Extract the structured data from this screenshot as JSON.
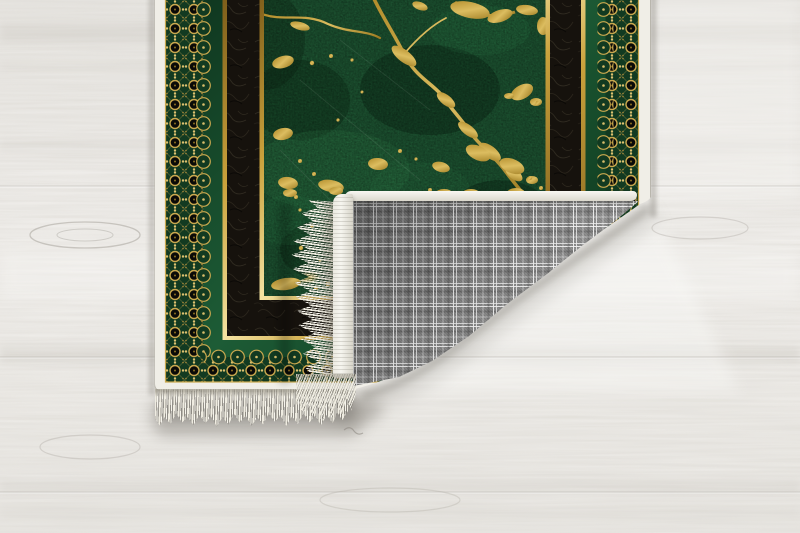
{
  "scene": {
    "type": "product-photograph",
    "subject": "Green gold-veined marble patterned area rug with ornate gold lace border and black band, bottom-right corner folded over showing gray tartan plaid woven backing and ivory fringe tassels, lying on a whitewashed wood plank floor",
    "rug": {
      "front_field": "dark green marble with gold veins",
      "border_bands": [
        "ivory binding",
        "gold lace filigree on dark green",
        "green strip",
        "gold pinstripe",
        "black textured band",
        "gold pinstripe"
      ],
      "backing": "gray tartan plaid weave",
      "fringe": "ivory tassels on short ends",
      "fold": "bottom-right corner folded over onto the rug"
    },
    "floor": "light whitewashed wood, horizontal grain with knots and plank seams"
  },
  "colors": {
    "floor-base": "#ebe9e6",
    "floor-light": "#f4f3f0",
    "binding": "#f0eee7",
    "lace-green": "#123a21",
    "gold": "#c7a44a",
    "gold-bright": "#eed688",
    "green-strip": "#175433",
    "black-band": "#16120d",
    "field-green": "#1c5130",
    "vein-gold": "#c79d33",
    "plaid-base": "#7e7e7e",
    "fringe": "#efece1",
    "shadow": "#8a867f"
  }
}
